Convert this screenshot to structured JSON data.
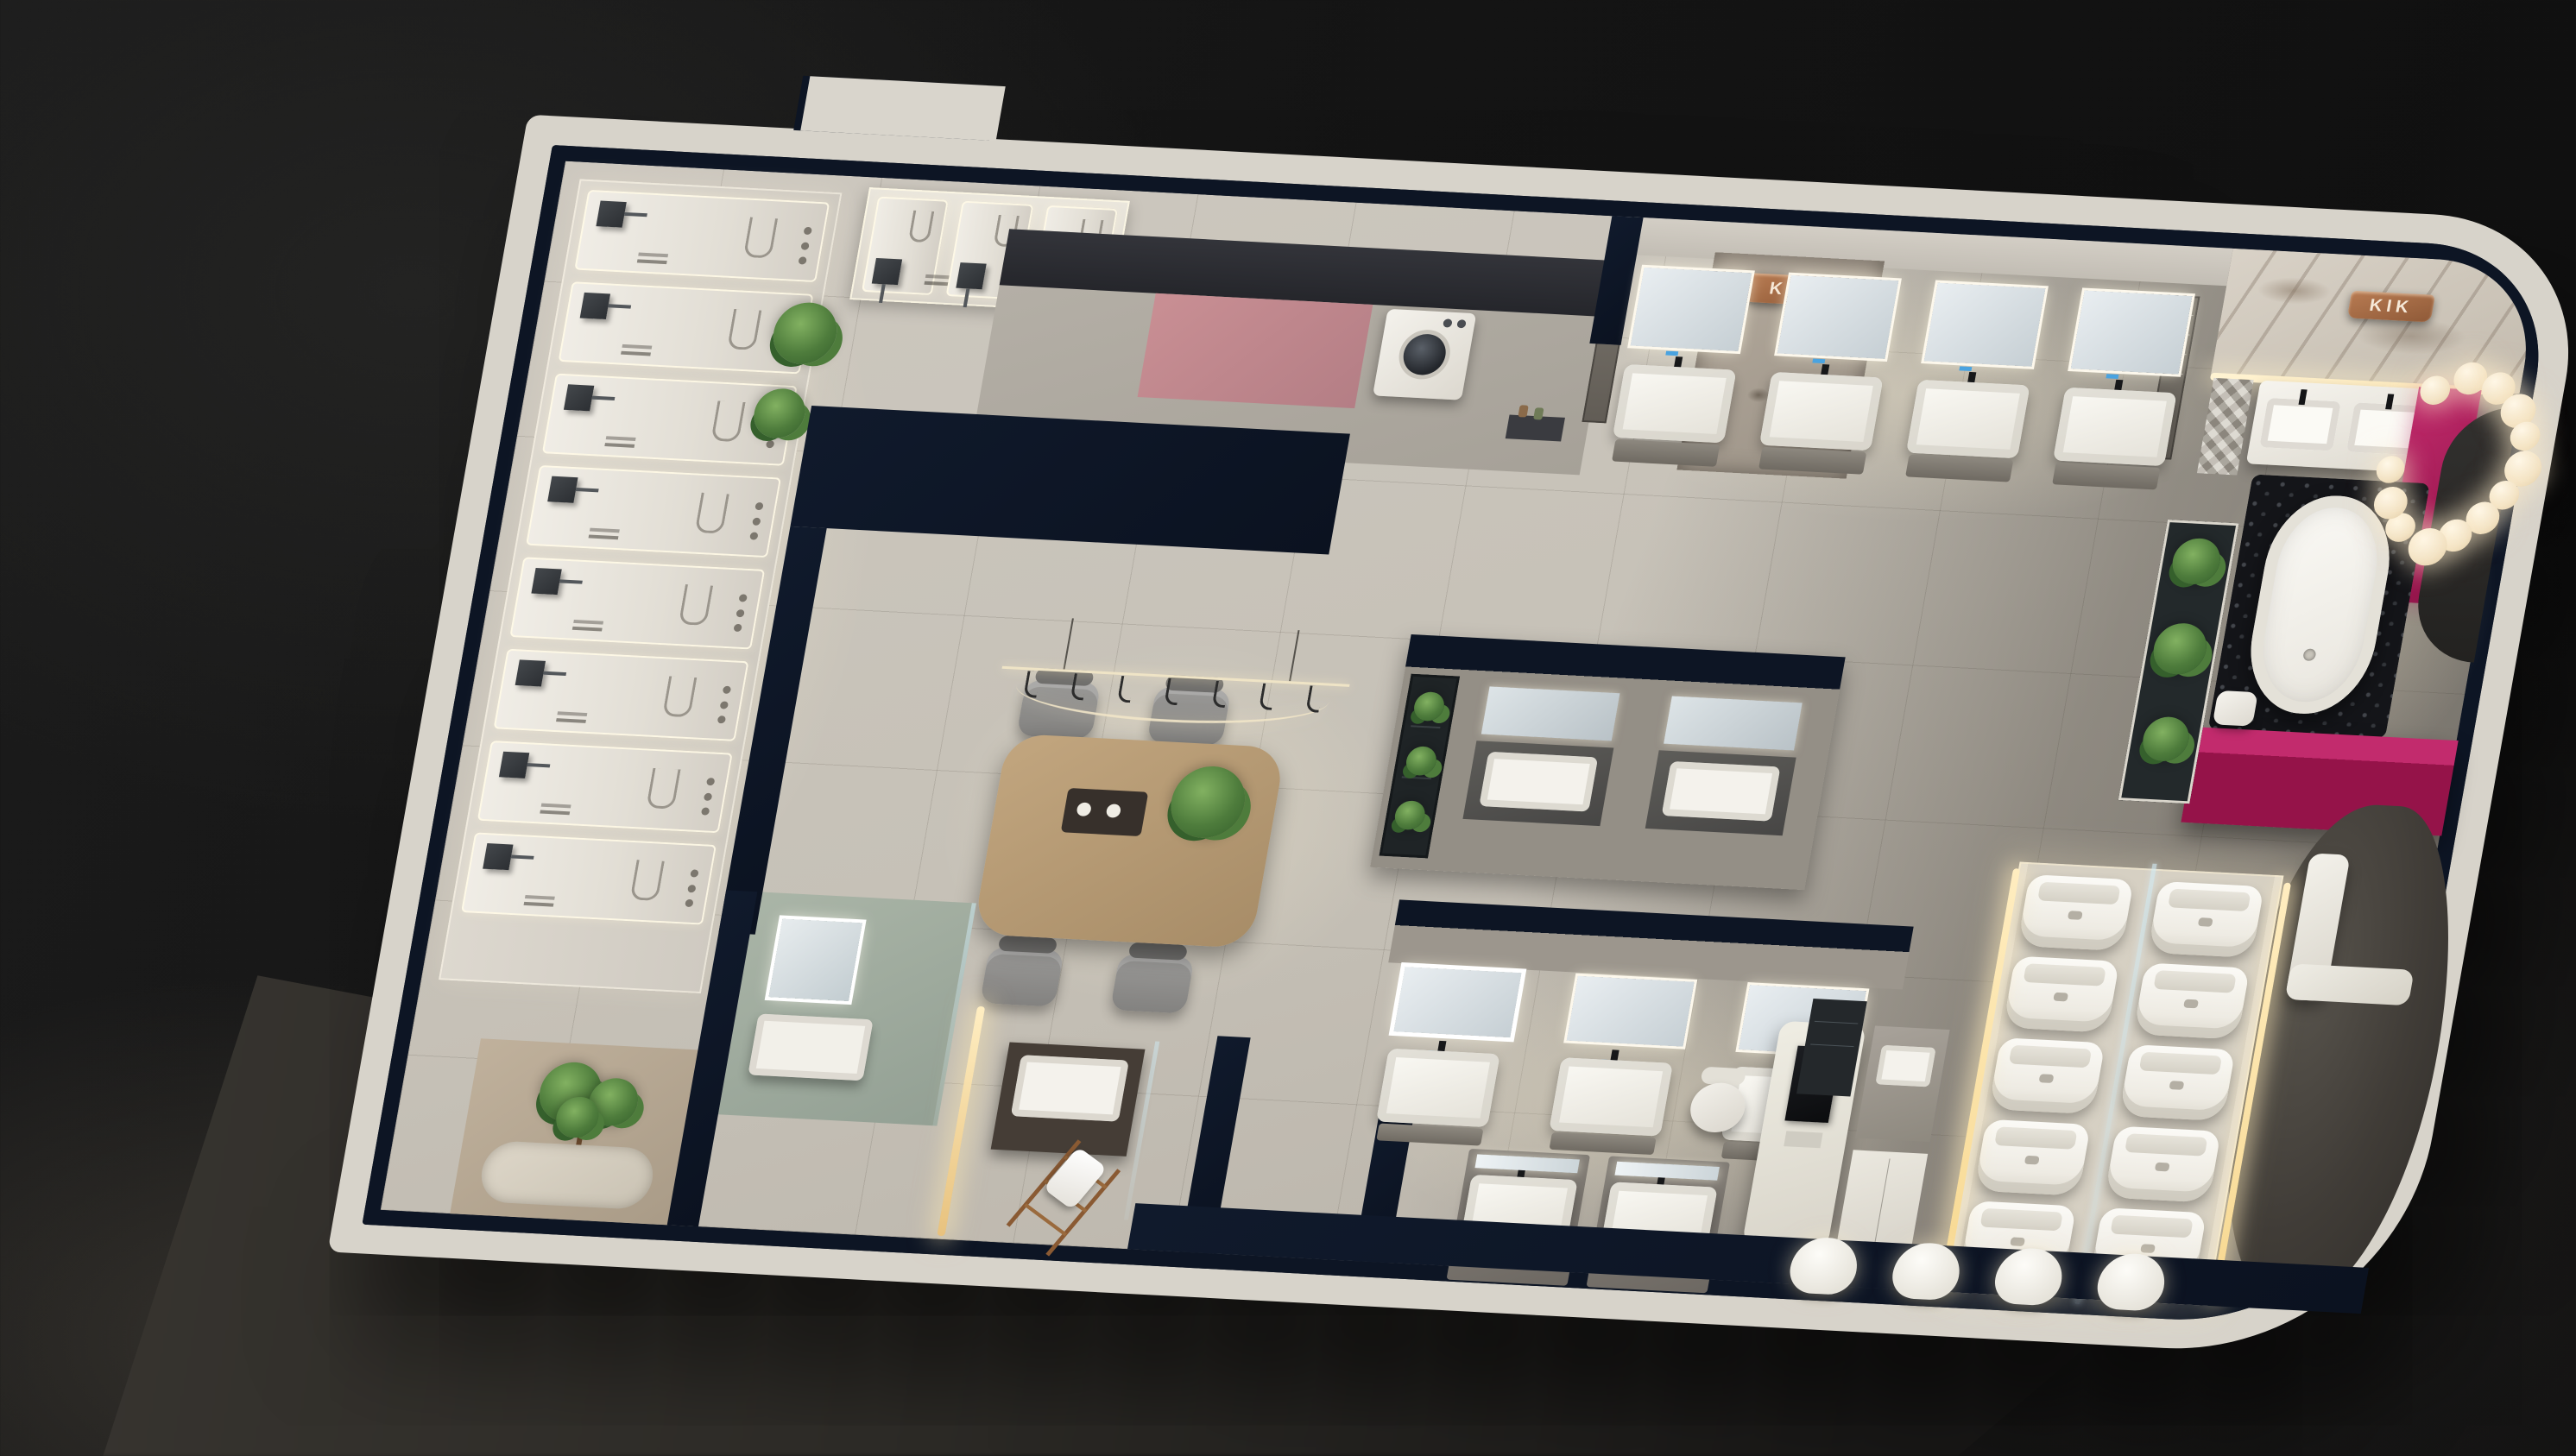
{
  "scene": {
    "description": "Top-down 3D render of a KIK sanitary-ware showroom floor plan at night, tilted on a dark studio background",
    "signs": {
      "kik_wall_sign": "KIK",
      "kik_marble_sign": "KIK"
    },
    "palette": {
      "background": "#161616",
      "floor": "#c6c1b7",
      "wall_dark_navy": "#0d1524",
      "wall_white": "#d7d3ca",
      "accent_magenta": "#a81f5c",
      "accent_rose": "#c08387",
      "copper_sign": "#a56a48",
      "warm_led": "#ffe9b8",
      "plant_green": "#4e7c3c",
      "wood_table": "#b59873",
      "glass": "#cfe3e8",
      "ceramic_white": "#f3f1ea"
    }
  },
  "zones": {
    "shower_gallery": {
      "label": "Shower panel display wall",
      "panel_count": 8,
      "upper_panel_count": 3,
      "plant_count": 2
    },
    "laundry": {
      "label": "Laundry corner with washer and rose counter",
      "washer_count": 1
    },
    "vanity_row_top": {
      "label": "Wall-hung vanity displays on top wall",
      "unit_count": 4
    },
    "stone_wall": {
      "label": "Granite feature wall with copper logo"
    },
    "bath_zone": {
      "label": "Freestanding bathtub vignette with magenta blocks",
      "bubble_count": 13,
      "tub_count": 1
    },
    "plant_bed": {
      "label": "Planter bed",
      "plant_count": 3
    },
    "meeting_area": {
      "label": "Consultation table",
      "chair_count": 4,
      "hook_count": 7
    },
    "island": {
      "label": "Island vanity display",
      "unit_count": 2
    },
    "vanity_row_center": {
      "label": "Center vanity display row",
      "unit_count": 3
    },
    "vanity_pair": {
      "label": "Twin vanity display",
      "unit_count": 2
    },
    "sales_desk": {
      "label": "Sales workstation with monitor and chair"
    },
    "toilet_gallery": {
      "label": "Smart toilet display rows behind glass",
      "column_count": 2,
      "per_column": 5
    },
    "basin_row": {
      "label": "Wall-hung basin row on bottom wall",
      "basin_count": 4
    },
    "fitting_room": {
      "label": "Sage fitting room with LED mirror"
    },
    "towel_corner": {
      "label": "Dark vanity with towel ladder"
    },
    "garden_corner": {
      "label": "Indoor garden corner with tree"
    },
    "bench": {
      "label": "Built-in white bench"
    },
    "arch": {
      "label": "Dark arch wall panel"
    }
  }
}
